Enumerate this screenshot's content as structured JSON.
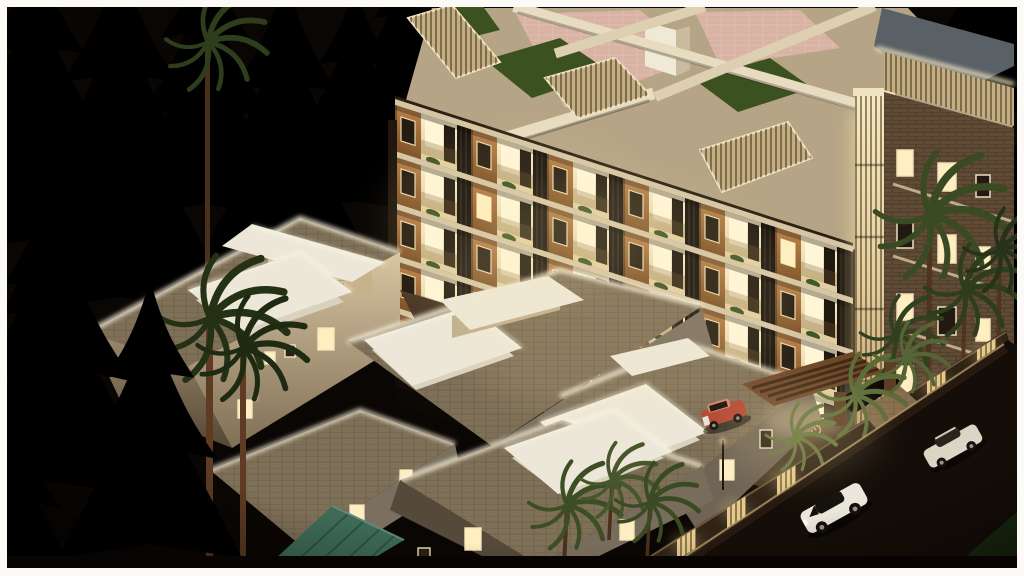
{
  "scene": {
    "title": "Night-time aerial 3D architectural rendering of a residential complex",
    "description": "Isometric aerial night view of a warmly lit multi-storey apartment tower with wood-and-cream balconies, rooftop terraces with pink tiling, lawn patches and pergola beams, surrounded by flat-roof villas with glowing parapets and skylight boxes, dark pine and palm trees, a compound wall with lit slat panels, a timber gate pergola, a paved courtyard with bicycles, a red car parked inside, and two white cars on the dark street at lower right",
    "objects": [
      "apartment-tower",
      "tower-rooftop-terrace",
      "roof-lawn-patches",
      "pink-tile-terrace",
      "pergola-beams",
      "louvered-roof-railings",
      "grey-top-slab",
      "corner-louver-light-column",
      "right-wing-facade",
      "villa-1",
      "villa-2",
      "villa-3",
      "villa-4",
      "villa-5",
      "skylight-boxes",
      "glowing-parapets",
      "courtyard-paving",
      "bicycles",
      "compound-wall",
      "lit-wall-panels",
      "gate-pergola",
      "driveway",
      "street",
      "red-parked-car",
      "white-suv",
      "white-sedan",
      "pine-trees",
      "palm-trees",
      "teal-metal-roof",
      "street-lamp",
      "grass-corner"
    ],
    "counts": {
      "tower_floors_visible": 6,
      "villas": 5,
      "cars": 3,
      "bicycles": 2,
      "lit_wall_panels": 6
    }
  },
  "palette": {
    "pageBg": "#fbfaf7",
    "night": "#0a0603",
    "treeDark": "#131d0b",
    "treeMid": "#1d2c10",
    "treeLight": "#2c3f17",
    "palmDark": "#2e3d1c",
    "palmLit": "#5c6c38",
    "trunk": "#5e3b22",
    "wood": "#a9753f",
    "woodDark": "#7e5226",
    "cream": "#e9d8b2",
    "creamBright": "#fff6d8",
    "balconyLit": "#f4e6bf",
    "glass": "#17110b",
    "windowLit": "#ffeec0",
    "slab": "#d5c5a4",
    "louver": "#c3ad83",
    "roofBase": "#b5a485",
    "roofPink": "#d8b2a2",
    "roofGrass": "#3c5120",
    "topSlab": "#596066",
    "wing": "#5f4b36",
    "villaRoof": "#7f7058",
    "villaWall": "#d8c5a2",
    "villaWallShade": "#746852",
    "parapet": "#f8f0da",
    "skylight": "#ece7d8",
    "ground": "#4a3a27",
    "pave": "#8a6f4e",
    "street": "#150e08",
    "curb": "#c7ab77",
    "wallDark": "#2f2315",
    "gateWood": "#6e4729",
    "grassDark": "#1b2a10",
    "tealRoof": "#3e6a57",
    "carRed": "#b34531",
    "carRedTop": "#d8816d",
    "carWhite": "#eae6dc",
    "carWhite2": "#dbd5c6",
    "carGlass": "#14100c",
    "glow": "#ffe9ad"
  }
}
